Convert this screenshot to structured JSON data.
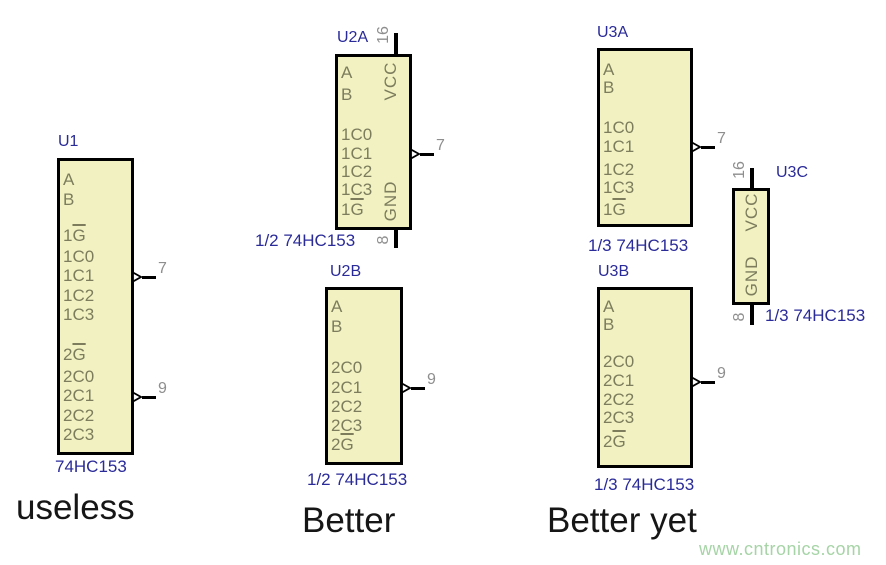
{
  "colors": {
    "chip_fill": "#f1f1c1",
    "chip_border": "#000000",
    "inner_text": "#7d7d5e",
    "pin_number": "#8e8e8e",
    "label_blue": "#2a2a99",
    "caption": "#161616",
    "watermark_green": "#a6d4a6"
  },
  "captions": [
    {
      "text": "useless"
    },
    {
      "text": "Better"
    },
    {
      "text": "Better yet"
    }
  ],
  "watermark": {
    "text": "www.cntronics.com",
    "color": "#a6d4a6"
  },
  "chips": [
    {
      "ref": "U1",
      "part": "74HC153",
      "box": {
        "x": 57,
        "y": 158,
        "w": 77,
        "h": 297
      },
      "ref_pos": {
        "x": 58,
        "y": 133
      },
      "part_pos": {
        "x": 55,
        "y": 457
      },
      "left_pins": [
        {
          "num": "14",
          "label": "A",
          "y": 180
        },
        {
          "num": "2",
          "label": "B",
          "y": 200
        },
        {
          "num": "1",
          "pre": "1",
          "bar": "G",
          "bubble": true,
          "y": 236
        },
        {
          "num": "6",
          "label": "1C0",
          "y": 257
        },
        {
          "num": "5",
          "label": "1C1",
          "y": 276
        },
        {
          "num": "4",
          "label": "1C2",
          "y": 296
        },
        {
          "num": "3",
          "label": "1C3",
          "y": 315
        },
        {
          "num": "15",
          "pre": "2",
          "bar": "G",
          "bubble": true,
          "y": 355
        },
        {
          "num": "10",
          "label": "2C0",
          "y": 377
        },
        {
          "num": "11",
          "label": "2C1",
          "y": 396
        },
        {
          "num": "12",
          "label": "2C2",
          "y": 416
        },
        {
          "num": "13",
          "label": "2C3",
          "y": 435
        }
      ],
      "right_pins": [
        {
          "num": "7",
          "label": "1Y",
          "y": 277,
          "pad": 5
        },
        {
          "num": "9",
          "label": "2Y",
          "y": 397,
          "pad": 5
        }
      ]
    },
    {
      "ref": "U2A",
      "part": "1/2 74HC153",
      "box": {
        "x": 335,
        "y": 54,
        "w": 77,
        "h": 176
      },
      "ref_pos": {
        "x": 337,
        "y": 29
      },
      "part_pos": {
        "x": 255,
        "y": 231
      },
      "top_pin": {
        "num": "16",
        "x": 396,
        "ext": 21
      },
      "bottom_pin": {
        "num": "8",
        "x": 396,
        "ext": 18
      },
      "vlabels": [
        {
          "text": "VCC",
          "cx": 391,
          "cy": 81
        },
        {
          "text": "GND",
          "cx": 391,
          "cy": 201
        }
      ],
      "left_pins": [
        {
          "num": "14",
          "label": "A",
          "y": 73
        },
        {
          "num": "2",
          "label": "B",
          "y": 95
        },
        {
          "num": "6",
          "label": "1C0",
          "y": 135
        },
        {
          "num": "5",
          "label": "1C1",
          "y": 154
        },
        {
          "num": "4",
          "label": "1C2",
          "y": 172
        },
        {
          "num": "3",
          "label": "1C3",
          "y": 190
        },
        {
          "num": "1",
          "pre": "1",
          "bar": "G",
          "bubble": true,
          "y": 210
        }
      ],
      "right_pins": [
        {
          "num": "7",
          "label": "1Y",
          "y": 154,
          "pad": 24
        }
      ]
    },
    {
      "ref": "U2B",
      "part": "1/2 74HC153",
      "box": {
        "x": 325,
        "y": 287,
        "w": 78,
        "h": 178
      },
      "ref_pos": {
        "x": 330,
        "y": 263
      },
      "part_pos": {
        "x": 307,
        "y": 470
      },
      "left_pins": [
        {
          "num": "14",
          "label": "A",
          "y": 307
        },
        {
          "num": "2",
          "label": "B",
          "y": 327
        },
        {
          "num": "10",
          "label": "2C0",
          "y": 368
        },
        {
          "num": "11",
          "label": "2C1",
          "y": 388
        },
        {
          "num": "12",
          "label": "2C2",
          "y": 407
        },
        {
          "num": "13",
          "label": "2C3",
          "y": 426
        },
        {
          "num": "15",
          "pre": "2",
          "bar": "G",
          "bubble": true,
          "y": 445
        }
      ],
      "right_pins": [
        {
          "num": "9",
          "label": "2Y",
          "y": 388,
          "pad": 7
        }
      ]
    },
    {
      "ref": "U3A",
      "part": "1/3 74HC153",
      "box": {
        "x": 597,
        "y": 48,
        "w": 96,
        "h": 179
      },
      "ref_pos": {
        "x": 597,
        "y": 24
      },
      "part_pos": {
        "x": 588,
        "y": 236
      },
      "left_pins": [
        {
          "num": "14",
          "label": "A",
          "y": 70
        },
        {
          "num": "2",
          "label": "B",
          "y": 88
        },
        {
          "num": "6",
          "label": "1C0",
          "y": 128
        },
        {
          "num": "5",
          "label": "1C1",
          "y": 147
        },
        {
          "num": "4",
          "label": "1C2",
          "y": 170
        },
        {
          "num": "3",
          "label": "1C3",
          "y": 188
        },
        {
          "num": "1",
          "pre": "1",
          "bar": "G",
          "bubble": true,
          "y": 210,
          "line": 40
        }
      ],
      "right_pins": [
        {
          "num": "7",
          "label": "1Y",
          "y": 147,
          "pad": 14
        }
      ]
    },
    {
      "ref": "U3B",
      "part": "1/3 74HC153",
      "box": {
        "x": 597,
        "y": 287,
        "w": 96,
        "h": 181
      },
      "ref_pos": {
        "x": 598,
        "y": 263
      },
      "part_pos": {
        "x": 594,
        "y": 475
      },
      "left_pins": [
        {
          "num": "14",
          "label": "A",
          "y": 307
        },
        {
          "num": "2",
          "label": "B",
          "y": 325
        },
        {
          "num": "10",
          "label": "2C0",
          "y": 362
        },
        {
          "num": "11",
          "label": "2C1",
          "y": 381
        },
        {
          "num": "12",
          "label": "2C2",
          "y": 400
        },
        {
          "num": "13",
          "label": "2C3",
          "y": 418
        },
        {
          "num": "15",
          "pre": "2",
          "bar": "G",
          "bubble": true,
          "y": 442
        }
      ],
      "right_pins": [
        {
          "num": "9",
          "label": "2Y",
          "y": 382,
          "pad": 4
        }
      ]
    },
    {
      "ref": "U3C",
      "part": "1/3 74HC153",
      "box": {
        "x": 732,
        "y": 188,
        "w": 38,
        "h": 117
      },
      "ref_pos": {
        "x": 776,
        "y": 164
      },
      "part_pos": {
        "x": 765,
        "y": 306
      },
      "top_pin": {
        "num": "16",
        "x": 752,
        "ext": 20
      },
      "bottom_pin": {
        "num": "8",
        "x": 752,
        "ext": 20
      },
      "vlabels": [
        {
          "text": "VCC",
          "cx": 752,
          "cy": 212
        },
        {
          "text": "GND",
          "cx": 752,
          "cy": 276
        }
      ]
    }
  ]
}
